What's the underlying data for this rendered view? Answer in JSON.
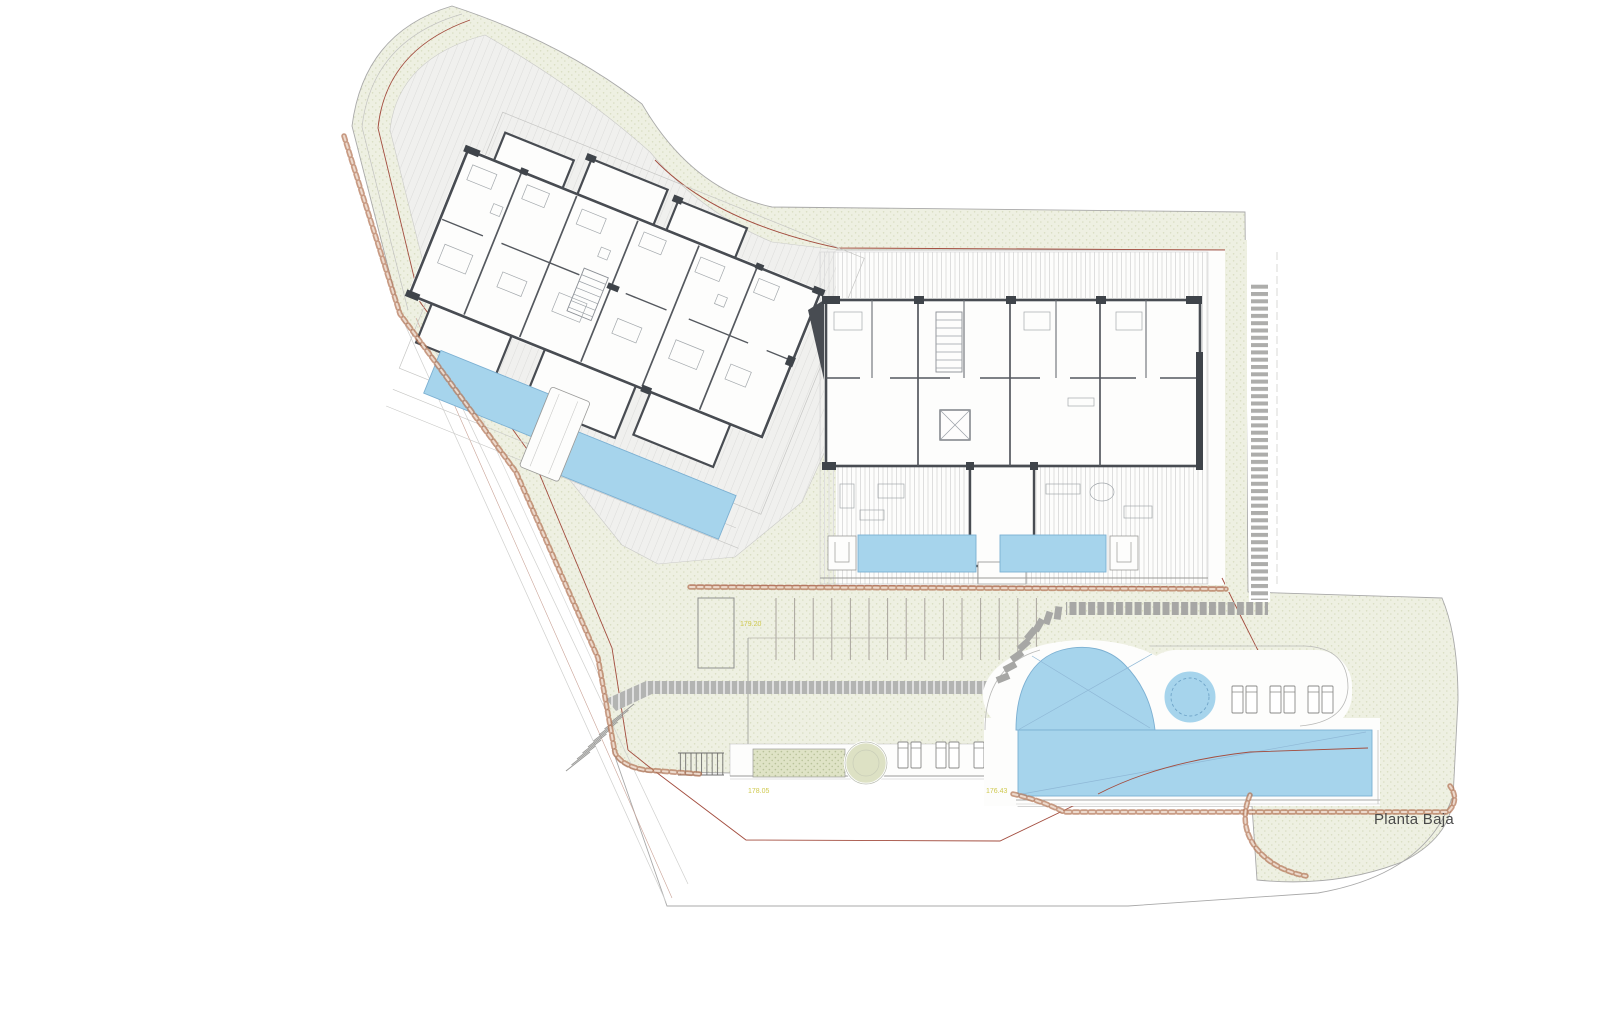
{
  "drawing": {
    "type": "architectural-site-plan-ground-floor",
    "floor_label": "Planta Baja",
    "elevation_labels": [
      {
        "id": "parking-level",
        "text": "179.20"
      },
      {
        "id": "path-west-level",
        "text": "178.05"
      },
      {
        "id": "path-east-level",
        "text": "176.43"
      }
    ],
    "features": {
      "buildings": [
        "west-wing",
        "east-wing"
      ],
      "pools": [
        "west-upper-lap-pool",
        "west-lower-lap-pool",
        "east-terrace-pool-west",
        "east-terrace-pool-east",
        "main-freeform-pool",
        "spa-circle"
      ],
      "parking_stall_count": 15,
      "sun_loungers_garden": 6,
      "sun_loungers_pool_deck": 6,
      "trees": 1
    },
    "palette": {
      "background": "#ffffff",
      "landscape_green": "#eef0e2",
      "landscape_dot": "#d9ddc2",
      "planter_green": "#dfe3c6",
      "pool_blue": "#a6d4ec",
      "pool_edge": "#7cb0d2",
      "wall_dark": "#474b52",
      "deck_grey": "#f0f0ee",
      "path_grey": "#b3b4b2",
      "paver_grey": "#a7a7a5",
      "stone_wall_brown": "#b5795b",
      "boundary_red": "#a34d3f",
      "label_yellow": "#cfc94e",
      "label_grey": "#4a4a4a"
    }
  }
}
